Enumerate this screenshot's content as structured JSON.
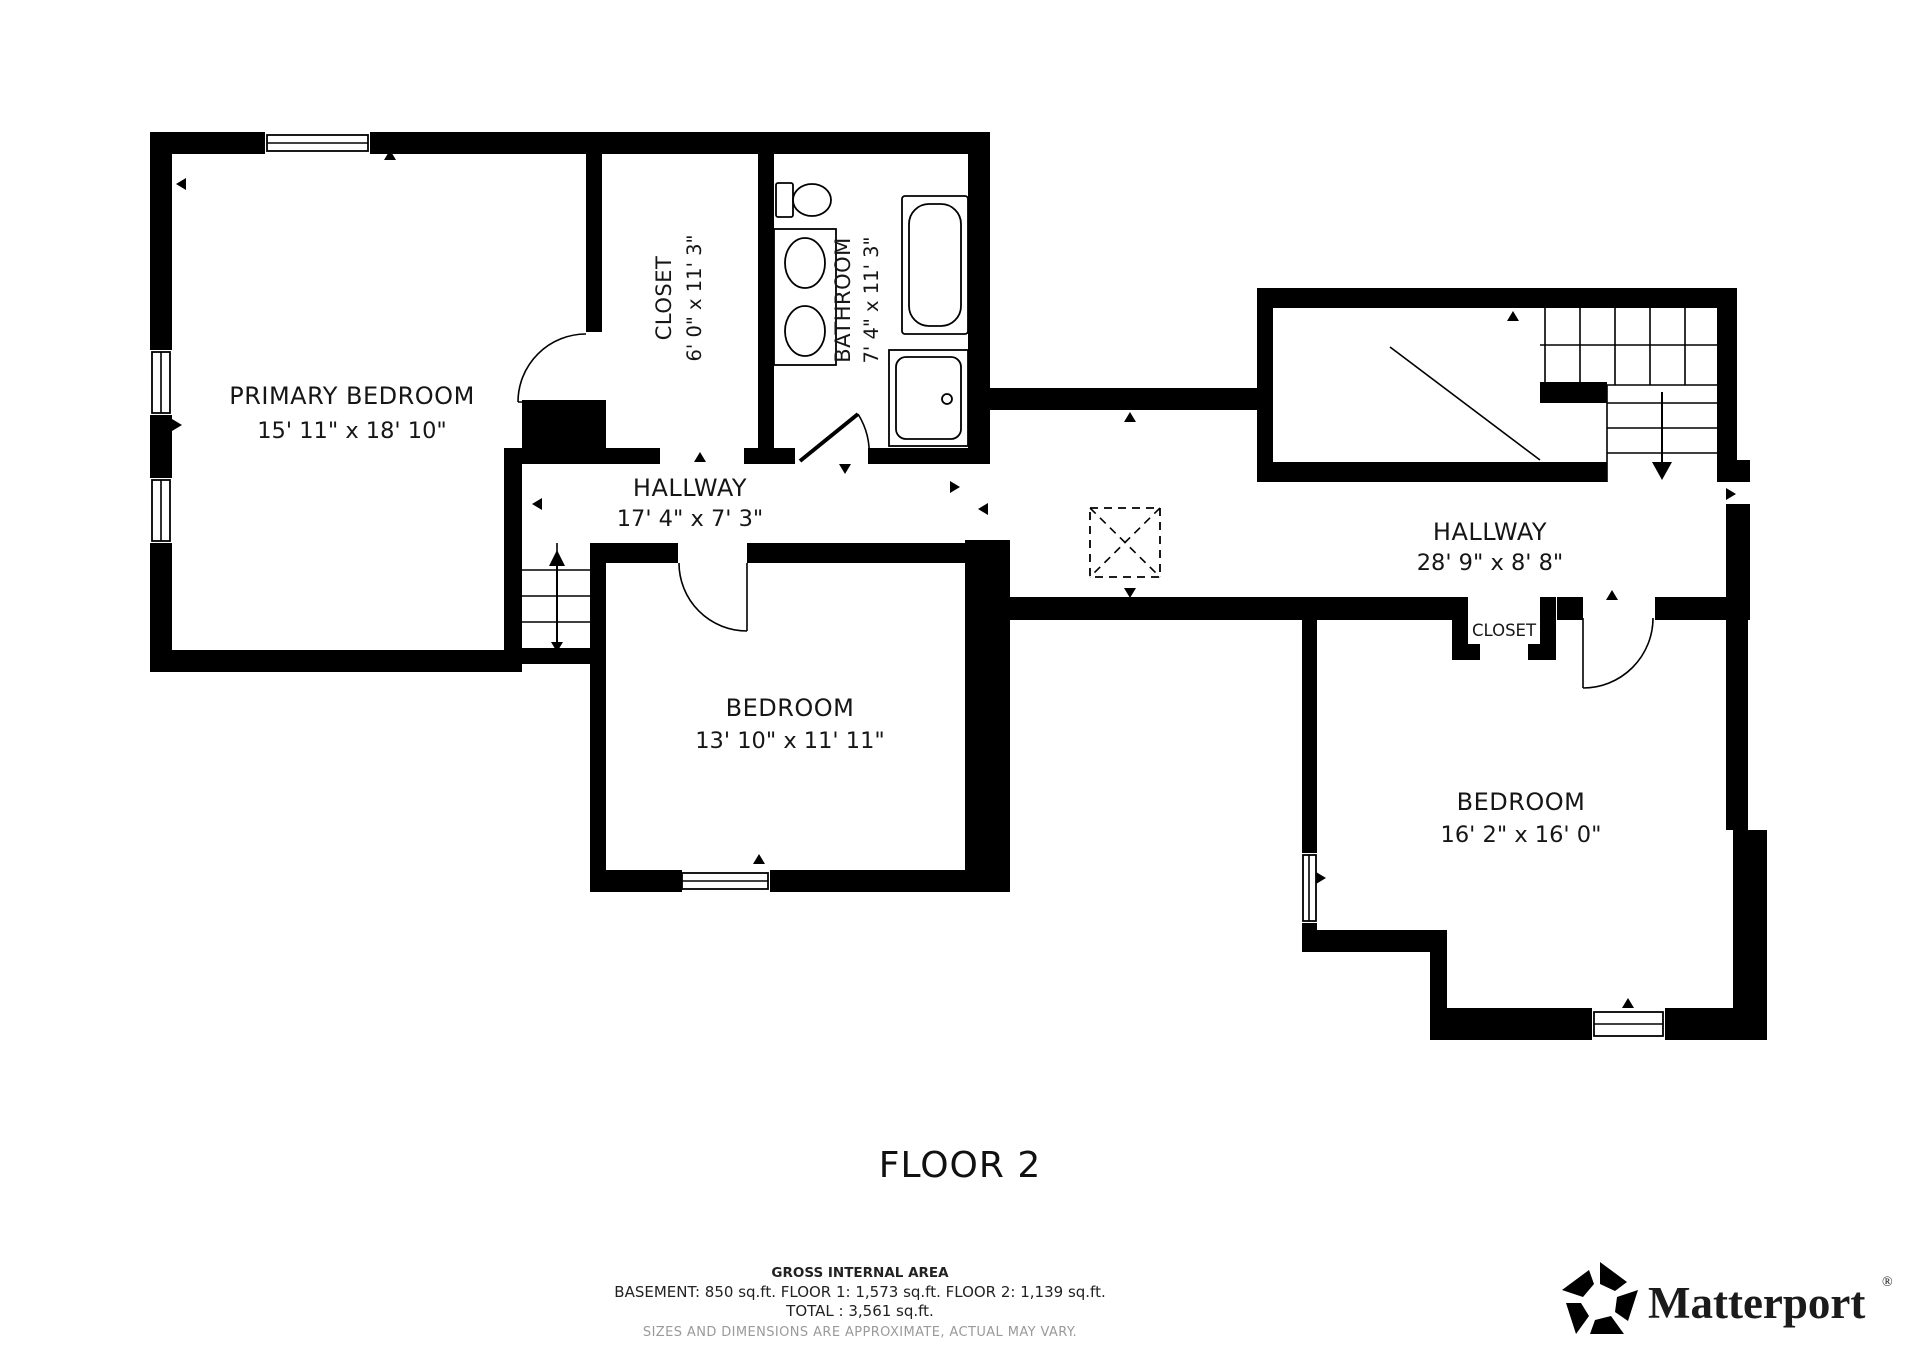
{
  "title": "FLOOR 2",
  "rooms": {
    "primary_bedroom": {
      "name": "PRIMARY BEDROOM",
      "dims": "15' 11\" x 18' 10\""
    },
    "closet_top": {
      "name": "CLOSET",
      "dims": "6' 0\" x 11' 3\""
    },
    "bathroom": {
      "name": "BATHROOM",
      "dims": "7' 4\" x 11' 3\""
    },
    "hallway_left": {
      "name": "HALLWAY",
      "dims": "17' 4\" x 7' 3\""
    },
    "bedroom_middle": {
      "name": "BEDROOM",
      "dims": "13' 10\" x 11' 11\""
    },
    "hallway_right": {
      "name": "HALLWAY",
      "dims": "28' 9\" x 8' 8\""
    },
    "closet_right": {
      "name": "CLOSET"
    },
    "bedroom_right": {
      "name": "BEDROOM",
      "dims": "16' 2\" x 16' 0\""
    }
  },
  "footer": {
    "area_title": "GROSS INTERNAL AREA",
    "area_line": "BASEMENT: 850 sq.ft.  FLOOR 1: 1,573 sq.ft.  FLOOR 2: 1,139 sq.ft.",
    "total_line": "TOTAL :  3,561 sq.ft.",
    "disclaimer": "SIZES AND DIMENSIONS ARE APPROXIMATE, ACTUAL MAY VARY."
  },
  "branding": {
    "logo_text": "Matterport",
    "registered": "®"
  },
  "colors": {
    "wall": "#000000",
    "background": "#ffffff",
    "disclaimer_gray": "#9a9a9a"
  }
}
